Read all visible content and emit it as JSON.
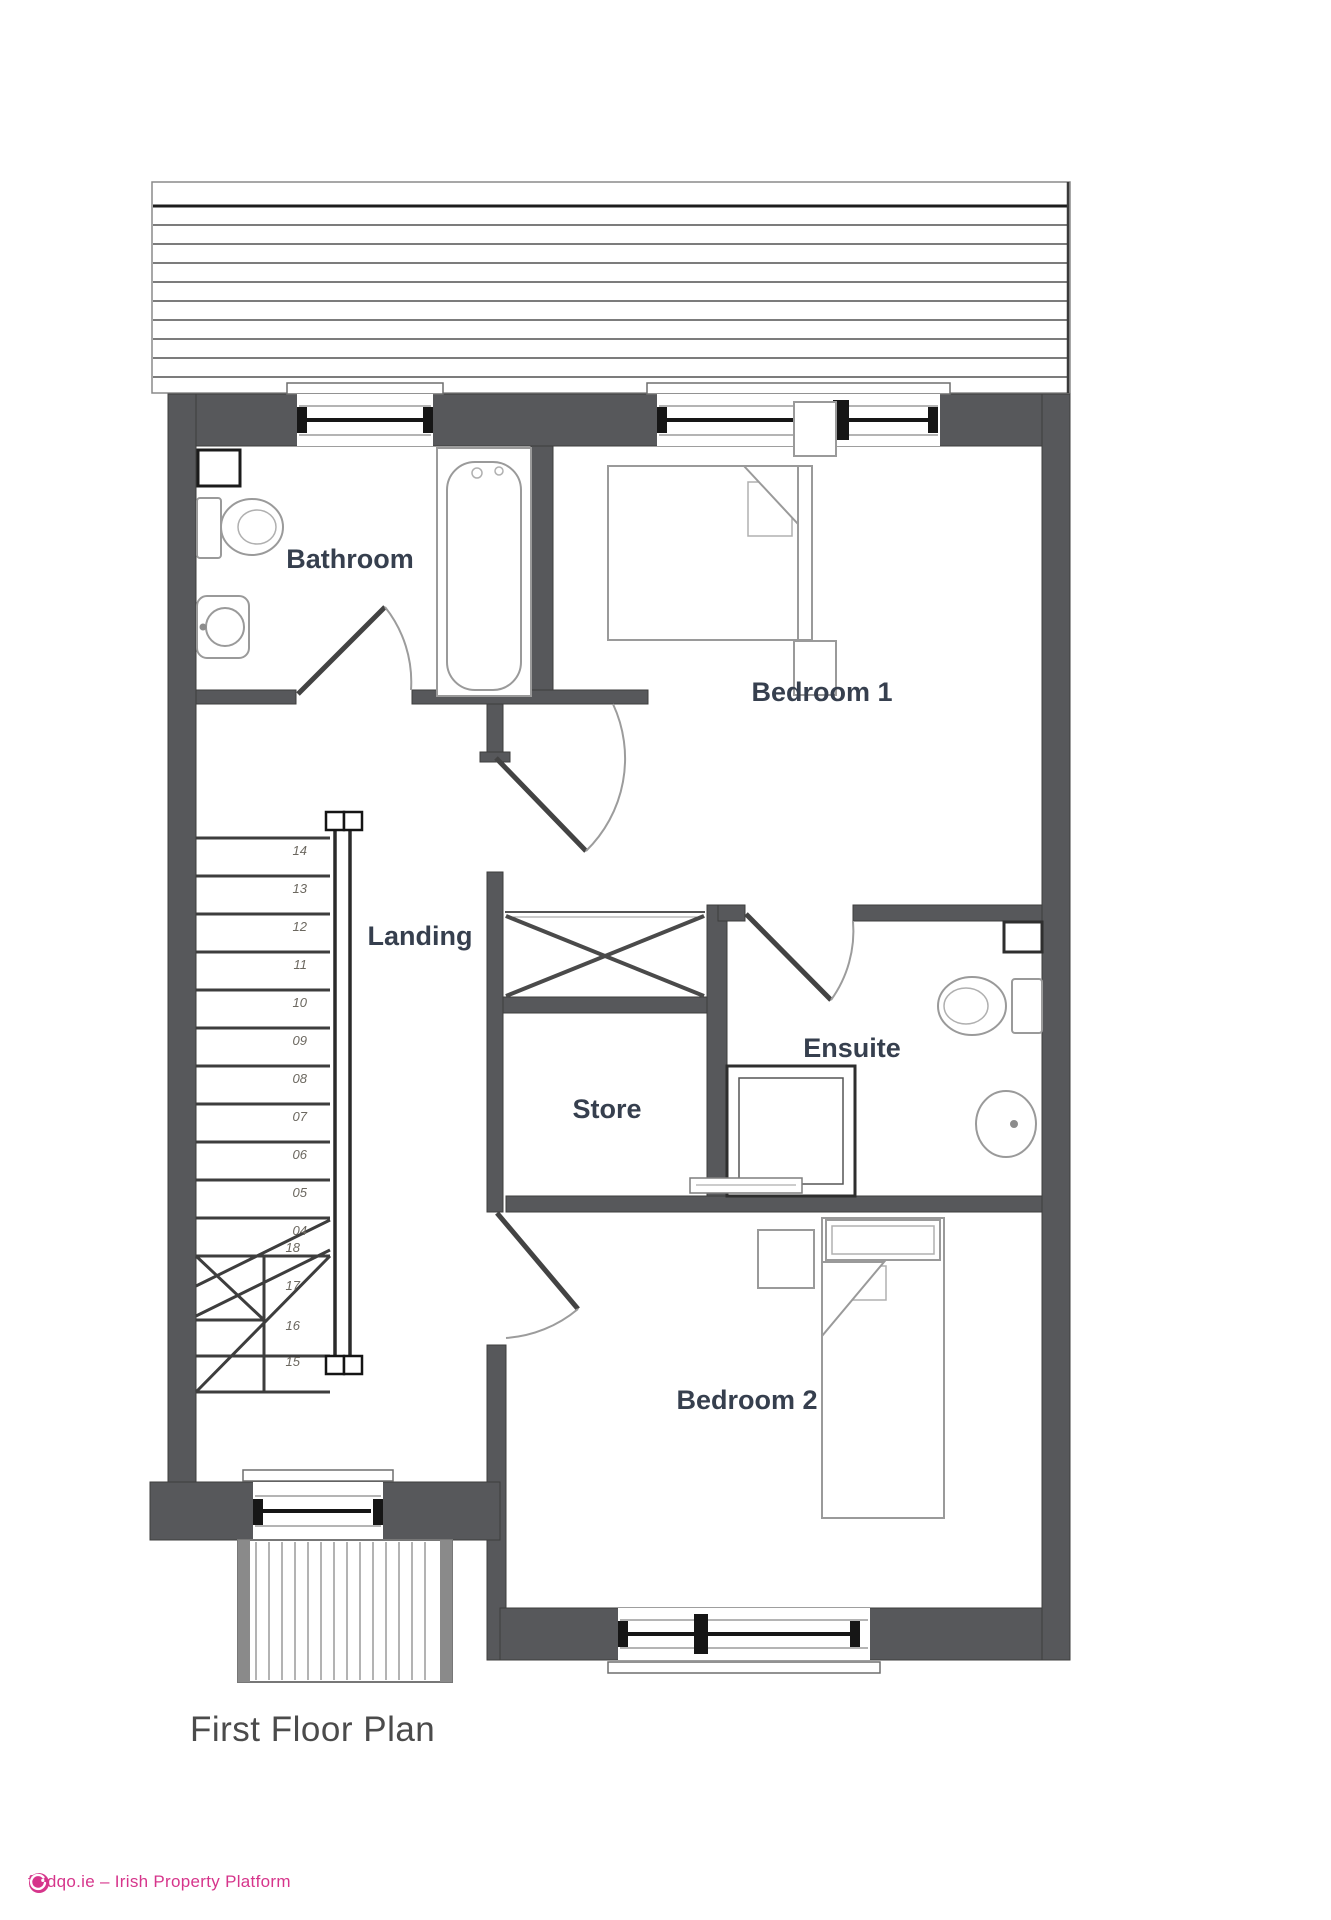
{
  "document": {
    "title": "First Floor Plan",
    "watermark": {
      "brand": "findqo.ie",
      "text": "findqo.ie – Irish Property Platform"
    }
  },
  "plan": {
    "rooms": [
      {
        "label": "Bathroom"
      },
      {
        "label": "Bedroom 1"
      },
      {
        "label": "Landing"
      },
      {
        "label": "Store"
      },
      {
        "label": "Ensuite"
      },
      {
        "label": "Bedroom 2"
      }
    ],
    "stairs": {
      "straight_treads": [
        "14",
        "13",
        "12",
        "11",
        "10",
        "09",
        "08",
        "07",
        "06",
        "05",
        "04"
      ],
      "winder_treads": [
        "18",
        "17",
        "16",
        "15"
      ]
    }
  },
  "colors": {
    "wall": "#57585b",
    "label_text": "#363f4e",
    "fixture_line": "#9a9a9a",
    "brand_pink": "#d6358b",
    "title_text": "#4b4b4b"
  }
}
